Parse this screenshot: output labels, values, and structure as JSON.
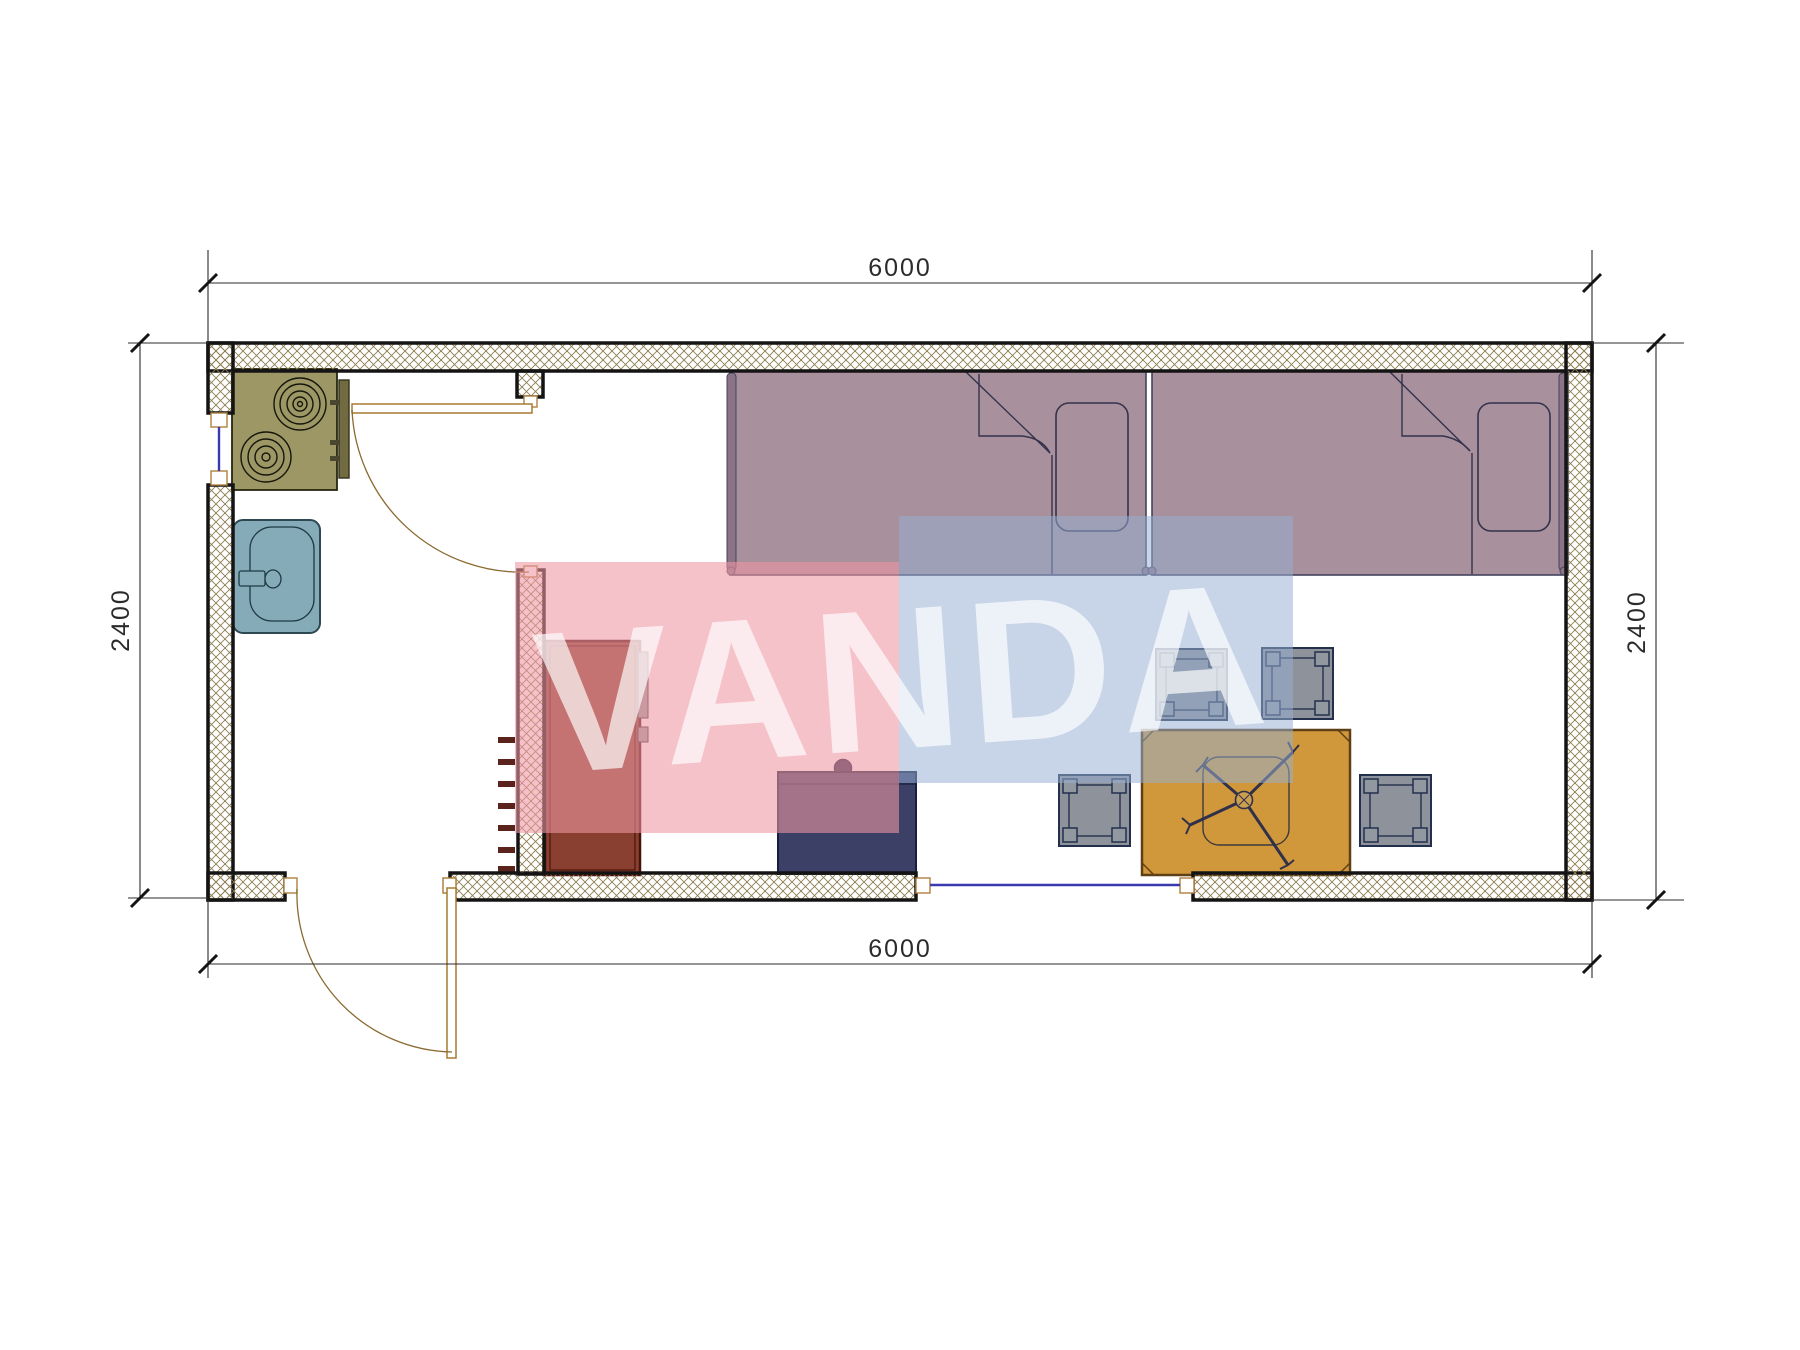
{
  "drawing": {
    "type": "floor-plan",
    "unit": "mm"
  },
  "dimensions": {
    "top": "6000",
    "bottom": "6000",
    "left": "2400",
    "right": "2400"
  },
  "watermark": {
    "text": "VANDA",
    "pink_color": "#f2b9c2",
    "blue_color": "#c4d3e7"
  },
  "colors": {
    "wall_hatch": "#8d7d50",
    "wall_outline": "#141414",
    "stove": "#9c9765",
    "sink": "#85aab8",
    "bed": "#a8909c",
    "wardrobe": "#8a4030",
    "cabinet_navy": "#3c4066",
    "table": "#d0983a",
    "stool": "#8e939b",
    "door_frame": "#b08040",
    "window_glass": "#3a3aae"
  },
  "elements": [
    "stove-icon",
    "sink-icon",
    "bed-icon",
    "bed-icon",
    "pillow-icon",
    "wardrobe-icon",
    "cabinet-icon",
    "table-icon",
    "ceiling-fan-icon",
    "stool-icon",
    "stool-icon",
    "stool-icon",
    "stool-icon",
    "door-swing-icon",
    "door-swing-icon",
    "window-icon",
    "window-icon"
  ]
}
